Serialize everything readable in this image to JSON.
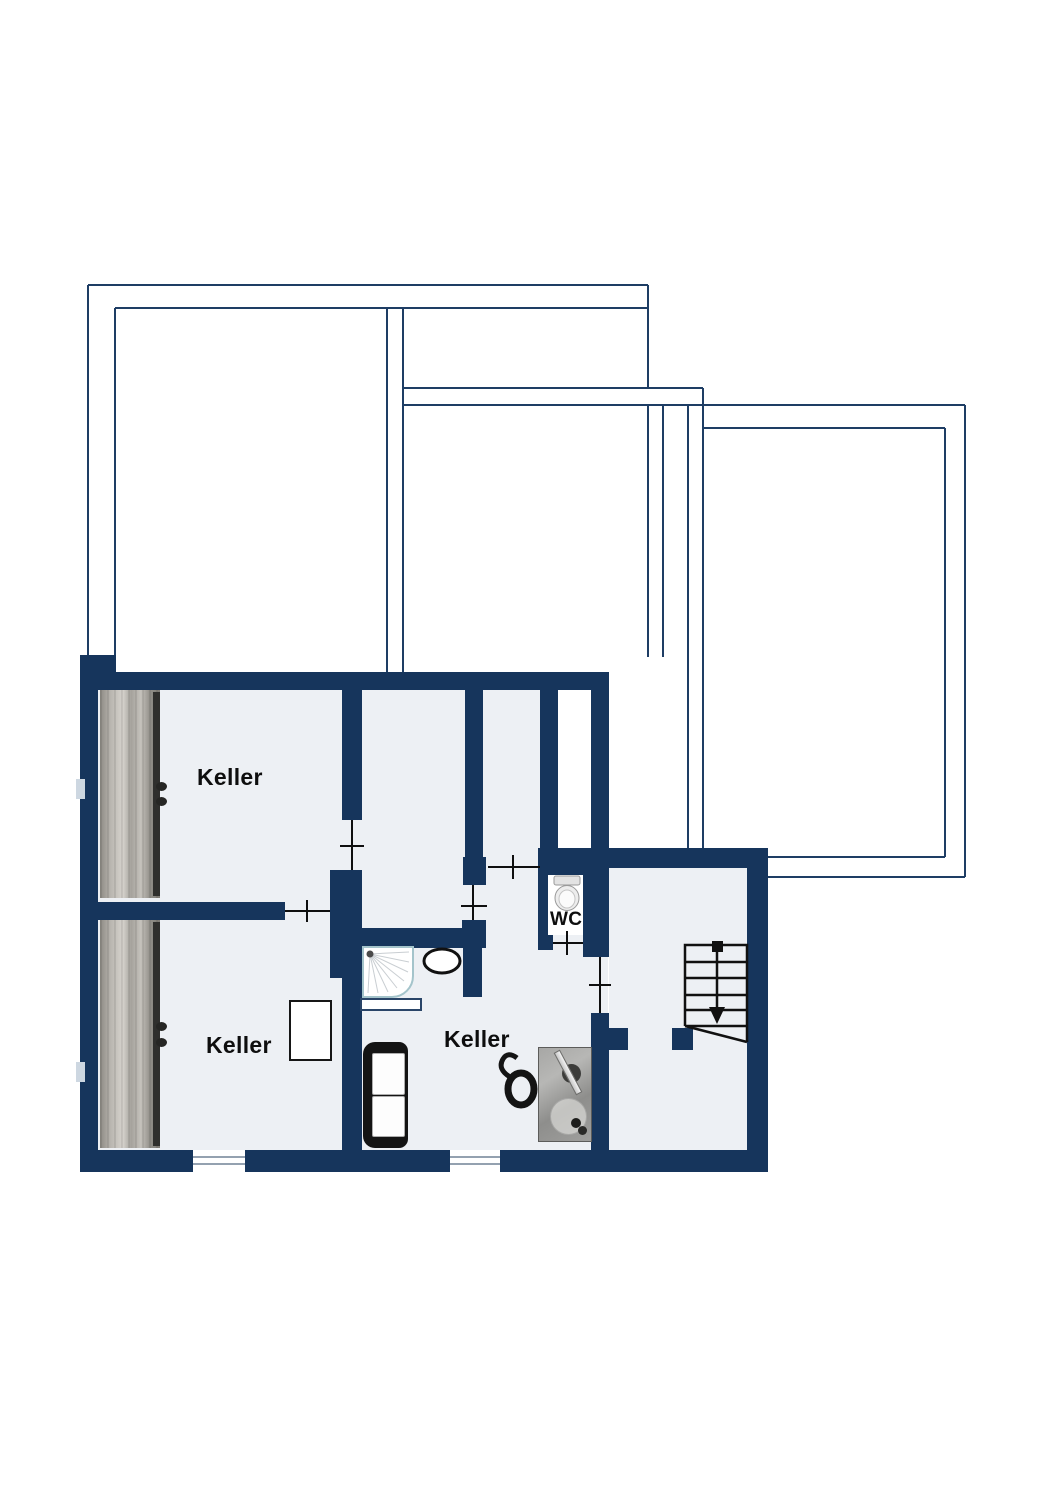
{
  "plan": {
    "type": "basement-floorplan",
    "rooms": [
      {
        "id": "keller-top-left",
        "label": "Keller"
      },
      {
        "id": "keller-bottom-left",
        "label": "Keller"
      },
      {
        "id": "keller-middle",
        "label": "Keller"
      },
      {
        "id": "wc",
        "label": "WC"
      }
    ],
    "fixtures": [
      "staircase-down-arrow",
      "toilet",
      "shower-tray",
      "washbasin-oval",
      "utility-sink-unit",
      "office-chair",
      "sofa",
      "cabinet",
      "wardrobe-top-left",
      "wardrobe-bottom-left",
      "window-bottom-left",
      "window-bottom-middle",
      "upper-floor-outline"
    ],
    "colors": {
      "wall": "#16355c",
      "floor": "#edf0f4",
      "upper_floor_outline": "#1e3d64",
      "label_text": "#0e0e0e",
      "background": "#ffffff"
    }
  }
}
